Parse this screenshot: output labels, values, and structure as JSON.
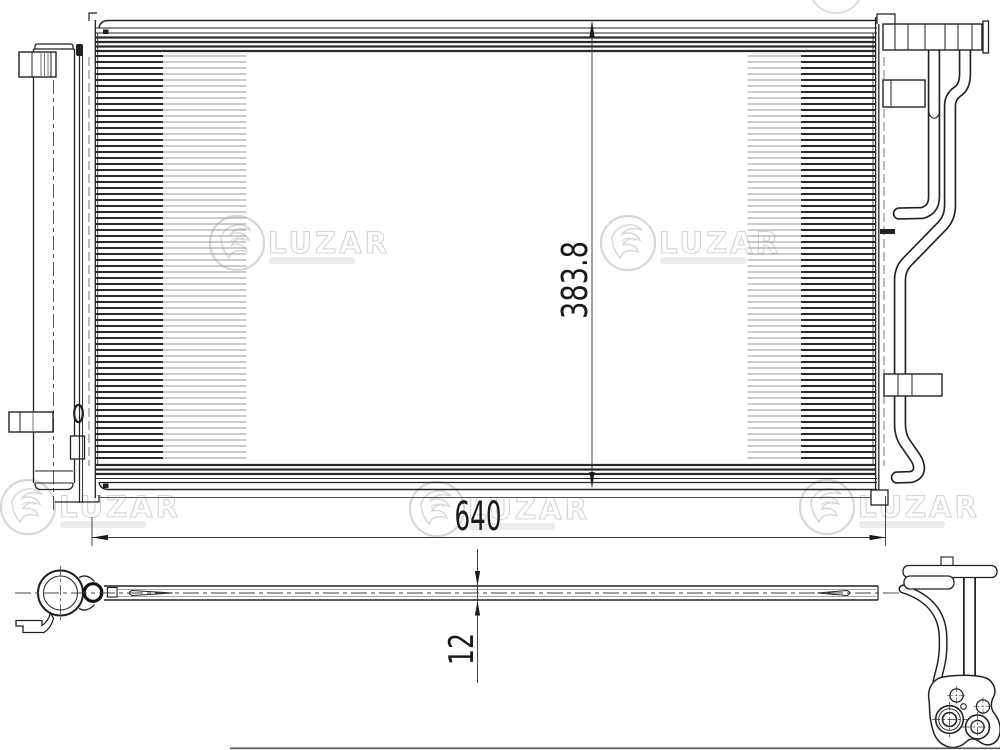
{
  "dimensions": {
    "width_mm": "640",
    "height_mm": "383.8",
    "thickness_mm": "12"
  },
  "watermark": {
    "brand": "LUZAR"
  },
  "colors": {
    "background": "#ffffff",
    "line": "#222222",
    "tube_line": "#2a2a2a",
    "thin_line": "#9a9a9a",
    "hidden_line": "#555555",
    "watermark": "#d7d7d7",
    "dim_text": "#1a1a1a"
  }
}
